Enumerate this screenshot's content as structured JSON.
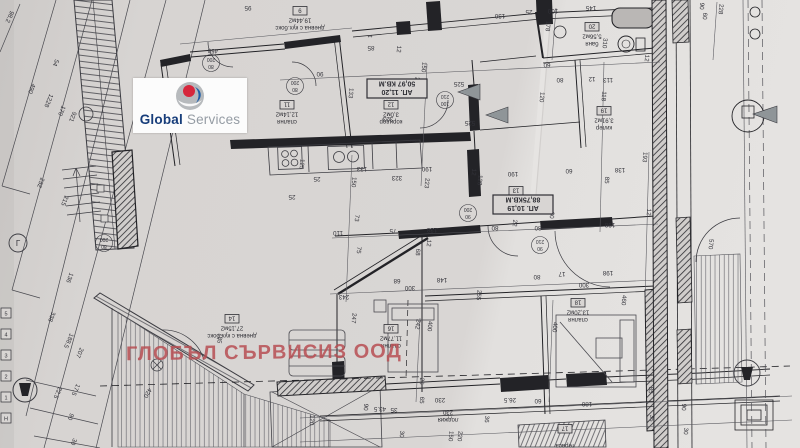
{
  "watermark": {
    "text": "ГЛОБЪЛ СЪРВИСИЗ ООД",
    "color": "rgba(183,77,82,0.85)"
  },
  "logo": {
    "word1": "Global",
    "word2": "Services",
    "word1_color": "#173d7a",
    "word2_color": "#959ca4",
    "circle_color": "#b7babd",
    "red": "#d6273c",
    "blue": "#1f5fa8"
  },
  "plan": {
    "paper_color": "#d8d5d3",
    "line_color": "#3c3c42",
    "wall_color": "#26262b",
    "apartments": [
      {
        "title": "АП. 11,20",
        "area": "50,97 КВ.М",
        "x": 397,
        "y": 88
      },
      {
        "title": "АП. 10,19",
        "area": "88,75КВ.М",
        "x": 523,
        "y": 204
      }
    ],
    "rooms": [
      {
        "tag": "9",
        "name": "дневна с кух.бокс",
        "area": "19,44м2",
        "x": 300,
        "y": 10
      },
      {
        "tag": "11",
        "name": "спалня",
        "area": "12,14м2",
        "x": 287,
        "y": 104
      },
      {
        "tag": "12",
        "name": "коридор",
        "area": "3,0м2",
        "x": 391,
        "y": 104
      },
      {
        "tag": "13",
        "name": "коридор",
        "area": "6,36м2",
        "x": 516,
        "y": 190
      },
      {
        "tag": "20",
        "name": "баня",
        "area": "5,56м2",
        "x": 592,
        "y": 26
      },
      {
        "tag": "19",
        "name": "килер",
        "area": "3,91м2",
        "x": 604,
        "y": 110
      },
      {
        "tag": "14",
        "name": "дневна с кух.бокс",
        "area": "27,15м2",
        "x": 232,
        "y": 318
      },
      {
        "tag": "16",
        "name": "спалня",
        "area": "11,77м2",
        "x": 391,
        "y": 328
      },
      {
        "tag": "18",
        "name": "спалня",
        "area": "13,20м2",
        "x": 578,
        "y": 302
      },
      {
        "tag": "",
        "name": "лоджия",
        "area": "230",
        "x": 448,
        "y": 402
      },
      {
        "tag": "17",
        "name": "тераса",
        "area": "",
        "x": 565,
        "y": 428
      }
    ],
    "door_tags": [
      {
        "w": "80",
        "h": "200",
        "x": 211,
        "y": 61
      },
      {
        "w": "80",
        "h": "200",
        "x": 295,
        "y": 84
      },
      {
        "w": "100",
        "h": "210",
        "x": 445,
        "y": 98
      },
      {
        "w": "90",
        "h": "200",
        "x": 468,
        "y": 211
      },
      {
        "w": "90",
        "h": "210",
        "x": 540,
        "y": 243
      },
      {
        "w": "80",
        "h": "200",
        "x": 104,
        "y": 241
      }
    ],
    "grid_markers": [
      "5",
      "4",
      "3",
      "2",
      "1",
      "Н"
    ],
    "symbols": [
      {
        "t": "Г",
        "x": 18,
        "y": 246,
        "r": 0,
        "s": 8
      }
    ],
    "dimensions": [
      {
        "t": "98.2",
        "x": 8,
        "y": 16,
        "r": 115
      },
      {
        "t": "490",
        "x": 30,
        "y": 88,
        "r": 113
      },
      {
        "t": "1228",
        "x": 47,
        "y": 100,
        "r": 113
      },
      {
        "t": "54",
        "x": 54,
        "y": 62,
        "r": 113
      },
      {
        "t": "170",
        "x": 60,
        "y": 110,
        "r": 113
      },
      {
        "t": "921",
        "x": 71,
        "y": 116,
        "r": 113
      },
      {
        "t": "232",
        "x": 39,
        "y": 182,
        "r": 112
      },
      {
        "t": "215",
        "x": 63,
        "y": 200,
        "r": 112
      },
      {
        "t": "136",
        "x": 68,
        "y": 277,
        "r": 112
      },
      {
        "t": "338",
        "x": 50,
        "y": 316,
        "r": 112
      },
      {
        "t": "188.5",
        "x": 67,
        "y": 340,
        "r": 114
      },
      {
        "t": "207",
        "x": 78,
        "y": 352,
        "r": 114
      },
      {
        "t": "22.5",
        "x": 56,
        "y": 392,
        "r": 114
      },
      {
        "t": "17.5",
        "x": 74,
        "y": 389,
        "r": 114
      },
      {
        "t": "90",
        "x": 69,
        "y": 416,
        "r": 114
      },
      {
        "t": "30",
        "x": 72,
        "y": 441,
        "r": 114
      },
      {
        "t": "420",
        "x": 146,
        "y": 392,
        "r": 120
      },
      {
        "t": "185",
        "x": 218,
        "y": 338,
        "r": 100
      },
      {
        "t": "450",
        "x": 213,
        "y": 49,
        "r": 183
      },
      {
        "t": "95",
        "x": 248,
        "y": 6,
        "r": 180
      },
      {
        "t": "130",
        "x": 500,
        "y": 14,
        "r": 180
      },
      {
        "t": "25",
        "x": 529,
        "y": 10,
        "r": 180
      },
      {
        "t": "100",
        "x": 553,
        "y": 9,
        "r": 180
      },
      {
        "t": "145",
        "x": 591,
        "y": 6,
        "r": 180
      },
      {
        "t": "178",
        "x": 546,
        "y": 26,
        "r": 95
      },
      {
        "t": "310",
        "x": 603,
        "y": 43,
        "r": 95
      },
      {
        "t": "90",
        "x": 700,
        "y": 6,
        "r": 95
      },
      {
        "t": "60",
        "x": 703,
        "y": 16,
        "r": 95
      },
      {
        "t": "228",
        "x": 719,
        "y": 9,
        "r": 95
      },
      {
        "t": "133",
        "x": 349,
        "y": 93,
        "r": 95
      },
      {
        "t": "12",
        "x": 397,
        "y": 49,
        "r": 95
      },
      {
        "t": "85",
        "x": 371,
        "y": 46,
        "r": 180
      },
      {
        "t": "90",
        "x": 320,
        "y": 72,
        "r": 180
      },
      {
        "t": "525",
        "x": 459,
        "y": 82,
        "r": 180
      },
      {
        "t": "525",
        "x": 470,
        "y": 121,
        "r": 180
      },
      {
        "t": "202",
        "x": 415,
        "y": 82,
        "r": 95
      },
      {
        "t": "150",
        "x": 422,
        "y": 67,
        "r": 95
      },
      {
        "t": "323",
        "x": 388,
        "y": 117,
        "r": 180
      },
      {
        "t": "60",
        "x": 547,
        "y": 63,
        "r": 180
      },
      {
        "t": "113",
        "x": 608,
        "y": 78,
        "r": 180
      },
      {
        "t": "12",
        "x": 592,
        "y": 77,
        "r": 180
      },
      {
        "t": "118",
        "x": 602,
        "y": 96,
        "r": 95
      },
      {
        "t": "120",
        "x": 540,
        "y": 97,
        "r": 95
      },
      {
        "t": "80",
        "x": 560,
        "y": 78,
        "r": 180
      },
      {
        "t": "12",
        "x": 645,
        "y": 58,
        "r": 95
      },
      {
        "t": "**",
        "x": 370,
        "y": 33,
        "r": 180,
        "s": 6
      },
      {
        "t": "***",
        "x": 413,
        "y": 137,
        "r": 180,
        "s": 6
      },
      {
        "t": "125",
        "x": 300,
        "y": 164,
        "r": 95
      },
      {
        "t": "25",
        "x": 317,
        "y": 177,
        "r": 180
      },
      {
        "t": "25",
        "x": 292,
        "y": 195,
        "r": 180
      },
      {
        "t": "133",
        "x": 362,
        "y": 167,
        "r": 180
      },
      {
        "t": "150",
        "x": 352,
        "y": 182,
        "r": 95
      },
      {
        "t": "323",
        "x": 397,
        "y": 176,
        "r": 180
      },
      {
        "t": "223",
        "x": 425,
        "y": 183,
        "r": 95
      },
      {
        "t": "190",
        "x": 427,
        "y": 167,
        "r": 180
      },
      {
        "t": "12",
        "x": 472,
        "y": 172,
        "r": 95
      },
      {
        "t": "128",
        "x": 478,
        "y": 180,
        "r": 95
      },
      {
        "t": "190",
        "x": 513,
        "y": 172,
        "r": 180
      },
      {
        "t": "73",
        "x": 355,
        "y": 218,
        "r": 95
      },
      {
        "t": "110",
        "x": 338,
        "y": 231,
        "r": 180
      },
      {
        "t": "75",
        "x": 393,
        "y": 229,
        "r": 180
      },
      {
        "t": "138",
        "x": 432,
        "y": 228,
        "r": 180
      },
      {
        "t": "12",
        "x": 427,
        "y": 243,
        "r": 95
      },
      {
        "t": "68",
        "x": 416,
        "y": 252,
        "r": 95
      },
      {
        "t": "75",
        "x": 357,
        "y": 250,
        "r": 95
      },
      {
        "t": "68",
        "x": 397,
        "y": 279,
        "r": 180
      },
      {
        "t": "148",
        "x": 442,
        "y": 278,
        "r": 180
      },
      {
        "t": "300",
        "x": 410,
        "y": 286,
        "r": 180
      },
      {
        "t": "243",
        "x": 344,
        "y": 295,
        "r": 180
      },
      {
        "t": "255",
        "x": 477,
        "y": 295,
        "r": 95
      },
      {
        "t": "80",
        "x": 495,
        "y": 226,
        "r": 180
      },
      {
        "t": "80",
        "x": 538,
        "y": 226,
        "r": 180
      },
      {
        "t": "60",
        "x": 550,
        "y": 215,
        "r": 95
      },
      {
        "t": "22",
        "x": 513,
        "y": 223,
        "r": 95
      },
      {
        "t": "193",
        "x": 643,
        "y": 157,
        "r": 95
      },
      {
        "t": "138",
        "x": 620,
        "y": 168,
        "r": 180
      },
      {
        "t": "85",
        "x": 605,
        "y": 180,
        "r": 95
      },
      {
        "t": "60",
        "x": 569,
        "y": 169,
        "r": 180
      },
      {
        "t": "198",
        "x": 610,
        "y": 223,
        "r": 180
      },
      {
        "t": "198",
        "x": 608,
        "y": 271,
        "r": 180
      },
      {
        "t": "300",
        "x": 584,
        "y": 283,
        "r": 180
      },
      {
        "t": "17",
        "x": 562,
        "y": 272,
        "r": 180
      },
      {
        "t": "80",
        "x": 537,
        "y": 275,
        "r": 180
      },
      {
        "t": "570",
        "x": 709,
        "y": 244,
        "r": 95
      },
      {
        "t": "460",
        "x": 622,
        "y": 300,
        "r": 95
      },
      {
        "t": "400",
        "x": 553,
        "y": 327,
        "r": 95
      },
      {
        "t": "247",
        "x": 352,
        "y": 318,
        "r": 95
      },
      {
        "t": "242",
        "x": 416,
        "y": 324,
        "r": 100
      },
      {
        "t": "400",
        "x": 428,
        "y": 326,
        "r": 95
      },
      {
        "t": "12",
        "x": 647,
        "y": 212,
        "r": 95
      },
      {
        "t": "25",
        "x": 420,
        "y": 381,
        "r": 95
      },
      {
        "t": "65",
        "x": 420,
        "y": 400,
        "r": 95
      },
      {
        "t": "43.5",
        "x": 380,
        "y": 407,
        "r": 180
      },
      {
        "t": "35",
        "x": 394,
        "y": 408,
        "r": 180
      },
      {
        "t": "30",
        "x": 400,
        "y": 434,
        "r": 95
      },
      {
        "t": "150",
        "x": 449,
        "y": 436,
        "r": 95
      },
      {
        "t": "220",
        "x": 458,
        "y": 436,
        "r": 95
      },
      {
        "t": "230",
        "x": 440,
        "y": 398,
        "r": 180
      },
      {
        "t": "26.5",
        "x": 510,
        "y": 398,
        "r": 180
      },
      {
        "t": "60",
        "x": 538,
        "y": 399,
        "r": 180
      },
      {
        "t": "180",
        "x": 587,
        "y": 402,
        "r": 180
      },
      {
        "t": "85",
        "x": 649,
        "y": 390,
        "r": 95
      },
      {
        "t": "35",
        "x": 650,
        "y": 418,
        "r": 95
      },
      {
        "t": "90",
        "x": 682,
        "y": 407,
        "r": 95
      },
      {
        "t": "30",
        "x": 684,
        "y": 431,
        "r": 95
      },
      {
        "t": "36",
        "x": 485,
        "y": 419,
        "r": 95
      },
      {
        "t": "90",
        "x": 364,
        "y": 407,
        "r": 95
      },
      {
        "t": "120",
        "x": 310,
        "y": 420,
        "r": 95
      }
    ]
  }
}
